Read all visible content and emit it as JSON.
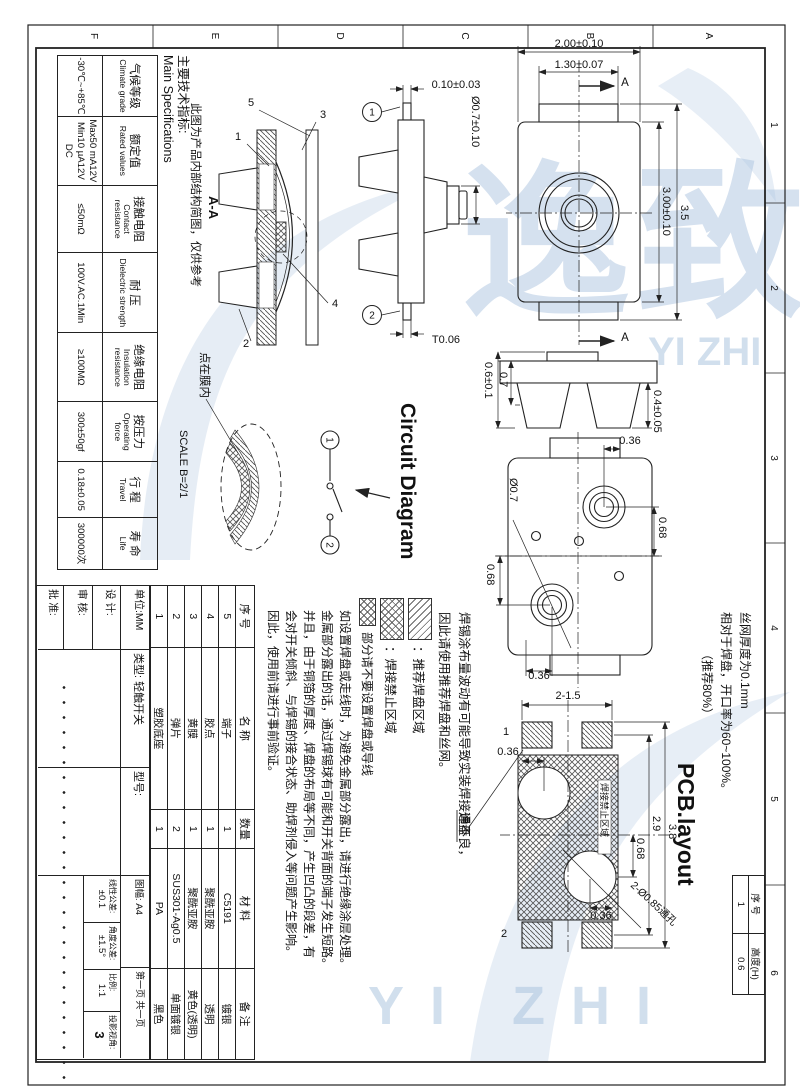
{
  "sheet": {
    "zone_letters": [
      "A",
      "B",
      "C",
      "D",
      "E",
      "F"
    ],
    "zone_numbers": [
      "1",
      "2",
      "3",
      "4",
      "5",
      "6"
    ]
  },
  "watermark": {
    "cjk": "逸致",
    "latin": "YI ZHI"
  },
  "spec": {
    "title_cn": "主要技术指标:",
    "title_en": "Main Specifications",
    "rows": [
      {
        "cn": "气候等级",
        "en": "Climate grade",
        "values": [
          "-30℃~+85℃"
        ]
      },
      {
        "cn": "额定值",
        "en": "Rated values",
        "values": [
          "Max50 mA12V",
          "Min10 µA12V DC"
        ]
      },
      {
        "cn": "接触电阻",
        "en": "Contact resistance",
        "values": [
          "≤50mΩ"
        ]
      },
      {
        "cn": "耐  压",
        "en": "Dielectric strength",
        "values": [
          "100V.AC.1Min"
        ]
      },
      {
        "cn": "绝缘电阻",
        "en": "Insulation resistance",
        "values": [
          "≥100MΩ"
        ]
      },
      {
        "cn": "按压力",
        "en": "Operating force",
        "values": [
          "300±50gf"
        ]
      },
      {
        "cn": "行  程",
        "en": "Travel",
        "values": [
          "0.18±0.05"
        ]
      },
      {
        "cn": "寿  命",
        "en": "Life",
        "values": [
          "300000次"
        ]
      }
    ]
  },
  "section_view": {
    "label": "A-A",
    "note": "此图为产品内部结构简图，仅供参考",
    "callouts": [
      "5",
      "1",
      "3",
      "4",
      "2"
    ]
  },
  "side_view": {
    "dim_pin": "0.10±0.03",
    "dim_stem": "Ø0.7±0.10",
    "dim_thickness": "T0.06",
    "terminal_1": "1",
    "terminal_2": "2"
  },
  "top_view": {
    "dim_width": "2.00±0.10",
    "dim_inner_width": "1.30±0.07",
    "dim_body_length": "3.00±0.10",
    "dim_total_length": "3.5",
    "section_arrow": "A"
  },
  "side_view2": {
    "dim_total_height": "0.7",
    "dim_body_height": "0.6±0.1",
    "dim_foot": "0.4±0.05"
  },
  "bottom_view": {
    "dim_offset_top": "0.36",
    "dim_offset_y1": "0.68",
    "dim_offset_y2": "0.68",
    "dim_offset_bottom": "0.36",
    "dim_rivet": "Ø0.7"
  },
  "detail_view": {
    "note": "点在膜内",
    "scale": "SCALE B=2/1"
  },
  "circuit": {
    "title": "Circuit Diagram",
    "t1": "1",
    "t2": "2"
  },
  "pcb": {
    "title": "PCB.layout",
    "stencil_note": [
      "丝网厚度为0.1mm",
      "相对于焊盘，开口率为60~100%。",
      "（推荐80%）"
    ],
    "pad_label": "焊盘",
    "keepout_label": "焊接禁止区域",
    "hole_label": "2-Ø0.85通孔",
    "pad_no_1": "1",
    "pad_no_2": "2",
    "dim_pad": "2-1.5",
    "dim_length": "3.8",
    "dim_pitch": "2.9",
    "dim_hole_y": "0.68",
    "dim_hole_x1": "0.36",
    "dim_hole_x2": "0.36"
  },
  "solder_note": {
    "line1": "焊锡涂布量波动有可能导致实装焊接通不良，",
    "line2": "因此请使用推荐焊盘和丝网。",
    "legend_recommended": "：推荐焊盘区域",
    "legend_prohibited": "：焊接禁止区域",
    "keepout_line": "部分请不要设置焊盘或导线",
    "paragraph": [
      "如设置焊盘或走线时，为避免金属部分露出，请进行绝缘涂层处理。",
      "金属部分露出的话，通过焊锡球有可能和开关背面的端子发生短路。",
      "并且，由于铜箔的厚度、焊盘的布局等不同，产生凹凸的段差，有",
      "会对开关倾斜、与焊锡的接合状态、助焊剂侵入等问题产生影响。",
      "因此，使用前请进行事前验证。"
    ]
  },
  "bom": {
    "headers": [
      "序 号",
      "名  称",
      "数量",
      "材  料",
      "备 注"
    ],
    "rows": [
      [
        "5",
        "端子",
        "1",
        "C5191",
        "镀银"
      ],
      [
        "4",
        "胶点",
        "1",
        "聚酰亚胺",
        "透明"
      ],
      [
        "3",
        "黄膜",
        "1",
        "聚酰亚胺",
        "黄色(透明)"
      ],
      [
        "2",
        "弹片",
        "2",
        "SUS301-Ag0.5",
        "单面镀银"
      ],
      [
        "1",
        "塑胶底座",
        "1",
        "PA",
        "黑色"
      ]
    ]
  },
  "title_block": {
    "unit": "单位:MM",
    "design": "设 计:",
    "check": "审 核:",
    "approve": "批 准:",
    "type_label": "类型:",
    "type_value": "轻触开关",
    "model_label": "型号:",
    "sheet_label": "图幅:",
    "sheet_value": "A4",
    "page": "第一页 共一页",
    "linear_label": "线性公差:",
    "linear_value": "±0.1",
    "angle_label": "角度公差:",
    "angle_value": "±1.5°",
    "scale_label": "比例:",
    "scale_value": "1:1",
    "projection_label": "投影视角:",
    "projection_value": "3"
  },
  "height_table": {
    "h_no": "序 号",
    "h_height": "高度(H)",
    "v_no": "1",
    "v_height": "0.6"
  }
}
